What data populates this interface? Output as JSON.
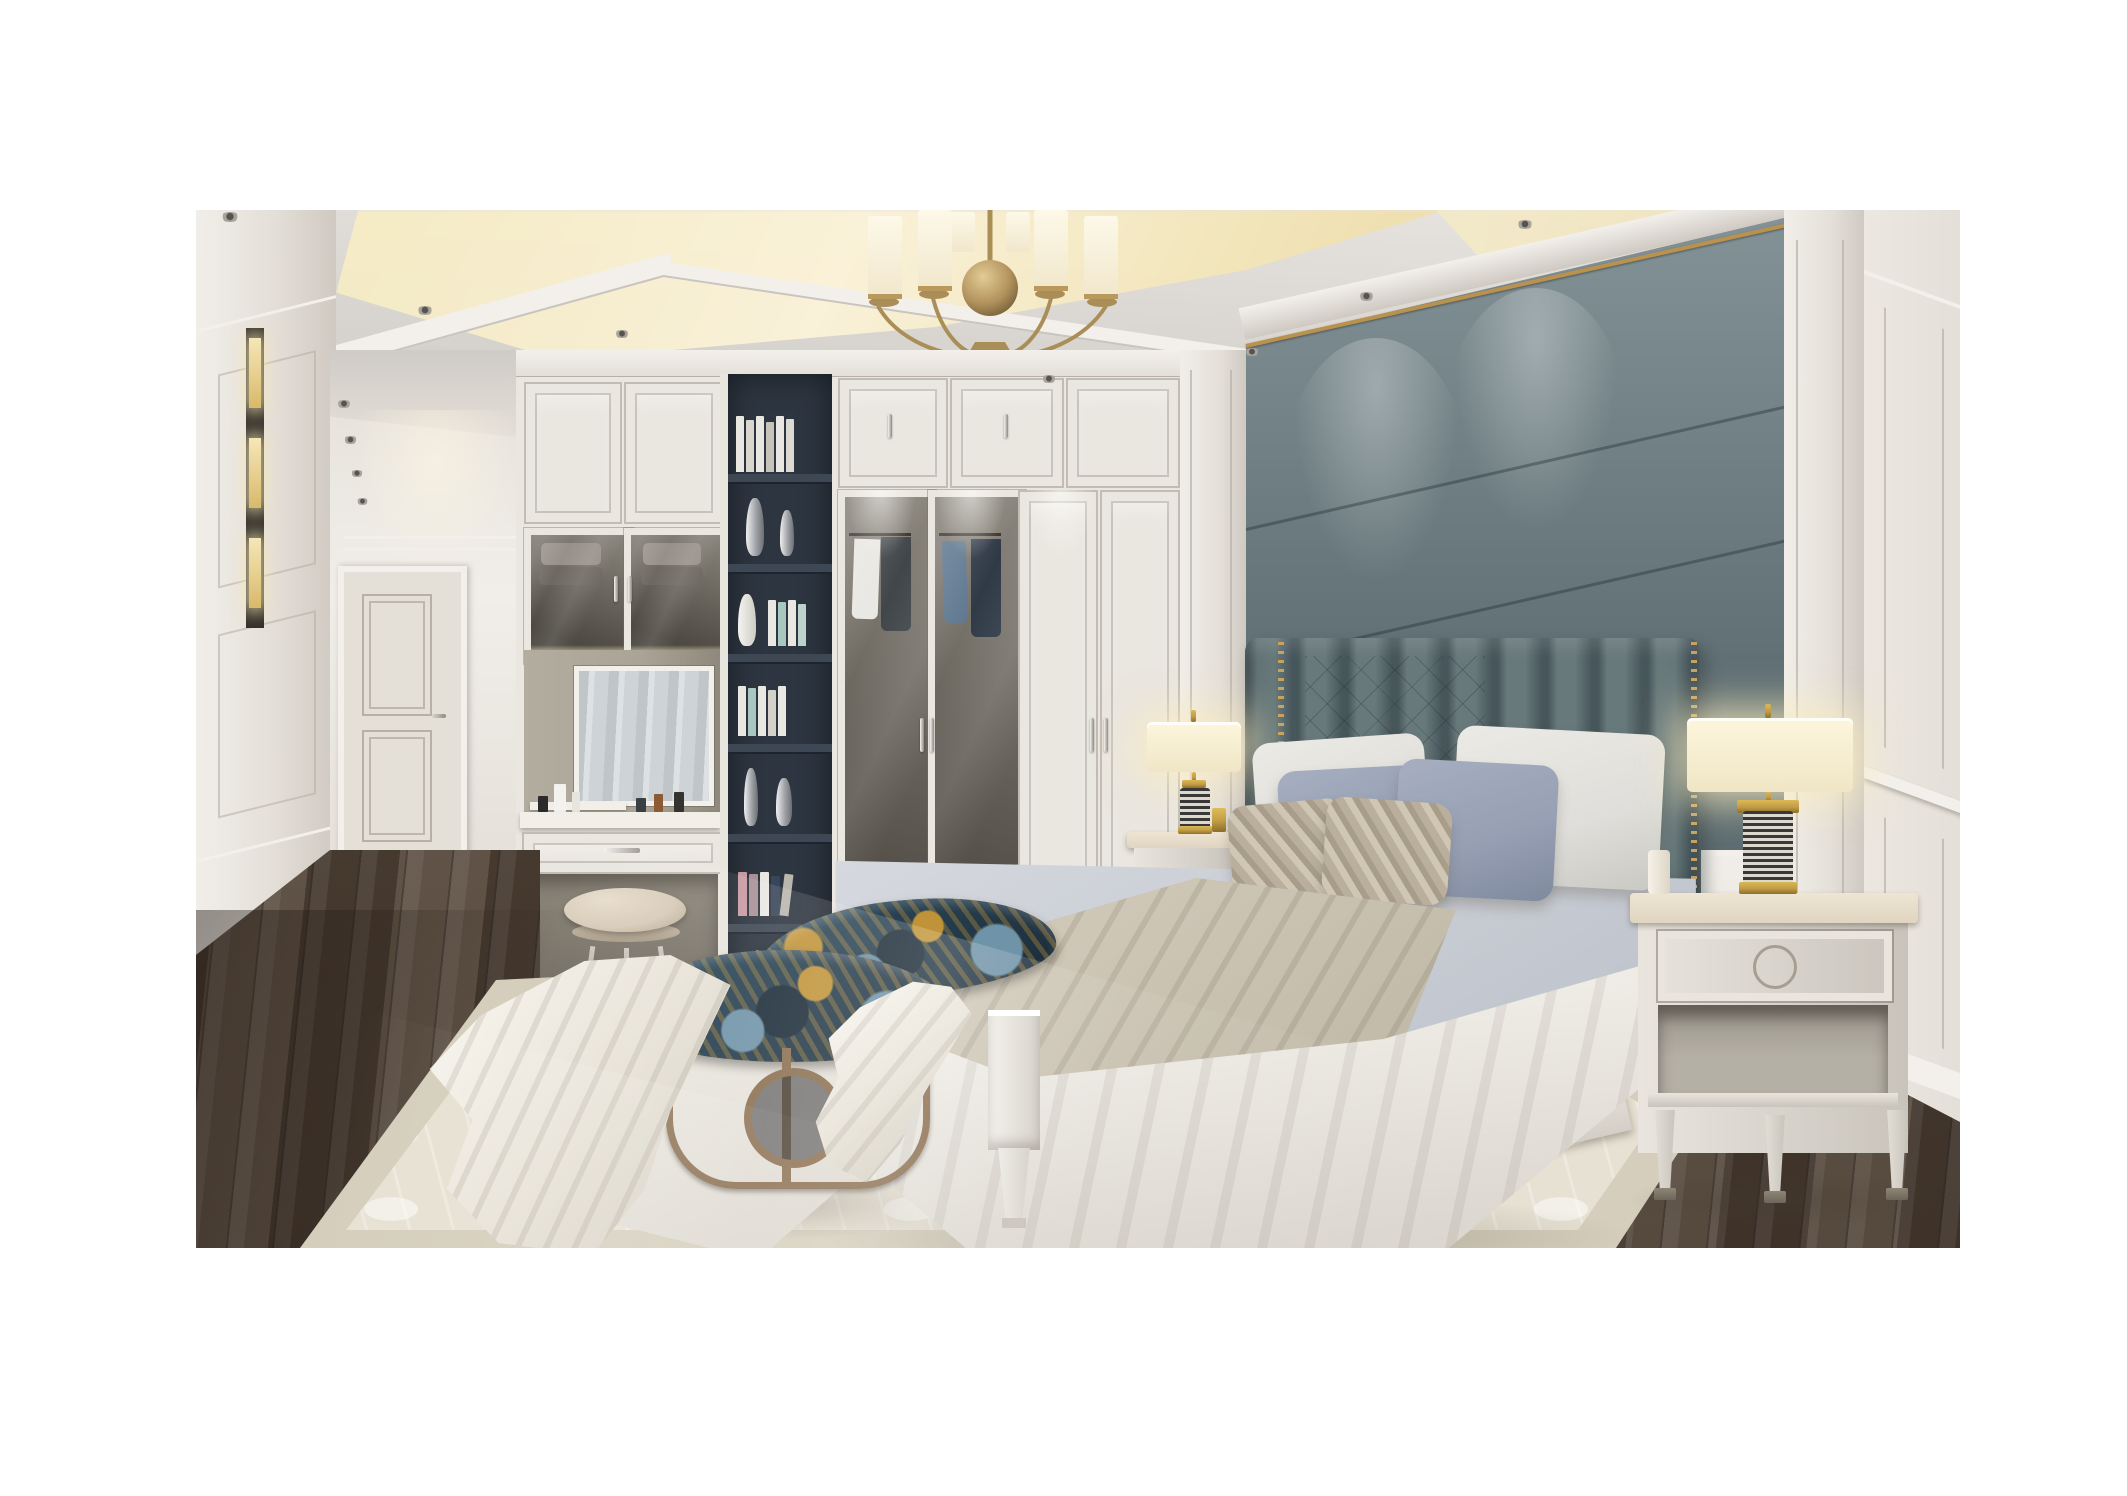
{
  "image": {
    "type": "photorealistic interior render",
    "room": "luxury neoclassical master bedroom with dressing hallway",
    "visible_text": null,
    "objects": [
      "brass chandelier with eight cylindrical frosted glass shades and central sphere",
      "tray ceiling with warm perimeter cove lighting and recessed round downlights",
      "white paneled hallway with interior two-panel door and lit display niches",
      "white built-in wardrobe wall with paneled doors and silver bar pulls",
      "glass display cabinet with folded towels and warm interior light",
      "built-in vanity with mirror, cosmetics, drawer and upholstered stool",
      "dark charcoal bookshelf niche with white books and silver vases",
      "two glass wardrobe doors showing hanging shirts and jackets",
      "gray-teal upholstered accent wall panels with brass top trim",
      "channel-tufted gray headboard with diamond quilting and brass nailhead trim",
      "king bed with light gray duvet, white draped sheet and taupe throw blanket",
      "pillows: two white euro pillows, two dusty-blue pillows, two striped tan accent pillows",
      "white wood bed frame with square tapered-leg footboard posts",
      "pair of cream nightstands with ring-pull drawer, open shelf and metal-capped legs",
      "two table lamps with cream drum shades and gold-banded striped column bases (lit)",
      "upholstered bench and round ottoman in teal-gold peacock fabric with bronze base",
      "white throw blanket draped over ottoman onto rug",
      "cream tone-on-tone patterned area rug with irregular edge",
      "dark walnut diagonal plank wood floor",
      "white wainscot side wall with chair rail and baseboard"
    ],
    "lighting": "warm cove glow and lit lamps against neutral daylight"
  },
  "palette": {
    "margin": "#ffffff",
    "ceil_hi": "#e8e5e1",
    "ceil_lo": "#cfcbc6",
    "cove": "#f6ecc6",
    "cove_core": "#fbf3d8",
    "cove_deep": "#f0e0ae",
    "wall_hi": "#f1eee9",
    "wall_mid": "#e4dfd8",
    "wall_lo": "#cfc9c2",
    "molding": "#f3f0ec",
    "molding_dk": "#c9c4be",
    "wardrobe": "#eae6e0",
    "panel_line": "#b7b0a7",
    "niche": "#f5e7b8",
    "glass_hi": "#8a857c",
    "glass_lo": "#4e4a43",
    "towel_hi": "#97908a",
    "towel_lo": "#6e6862",
    "mirror_hi": "#dde1e3",
    "mirror_lo": "#bfc5c8",
    "vanity_back": "#aaa496",
    "counter": "#f2efe8",
    "stool": "#d8cbb9",
    "silver": "#b6b1a9",
    "shelf_bg": "#2d3540",
    "shelf_board": "#3e4754",
    "book_white": "#e9e7e1",
    "book_teal": "#a9c7c1",
    "book_pink": "#c79aa0",
    "book_navy": "#39455a",
    "vase_hi": "#f0f0f2",
    "vase_lo": "#6c6f73",
    "accent_hi": "#839296",
    "accent_lo": "#5c6c71",
    "accent_gold": "#b8924e",
    "hb_hi": "#68797b",
    "hb_lo": "#46565b",
    "nail_gold": "#c7a160",
    "sheet": "#efece6",
    "sheet_dk": "#d6d1c9",
    "duvet_hi": "#d7dae0",
    "duvet_lo": "#b8bdc6",
    "throw_hi": "#d8d1c1",
    "throw_lo": "#b7af9d",
    "pil_white": "#dfdeda",
    "pil_blue": "#97a0b4",
    "pil_tan": "#b9af9c",
    "bench_teal": "#2f4d60",
    "bench_navy": "#1c2c39",
    "bench_gold": "#c09338",
    "bench_blue": "#6f93a8",
    "bronze": "#8a6e4f",
    "bed_wood_hi": "#f0ede7",
    "bed_wood_lo": "#d3cec6",
    "wood_hi": "#7b6a59",
    "wood_mid": "#645447",
    "wood_dk": "#483b30",
    "rug_field": "#e7e1d3",
    "rug_border": "#d5cebc",
    "rug_pat": "#f1ecdf",
    "shade_hi": "#fdf6dd",
    "shade_lo": "#f0e6c6",
    "gold": "#c19c44",
    "lamp_dark": "#383838",
    "lamp_light": "#ddd8cd",
    "nstand_hi": "#e9e5de",
    "nstand_lo": "#c8c3bb",
    "nstand_top": "#eee5d2",
    "door_leaf": "#e4dfd7",
    "glow": "rgba(250,236,190,0.8)",
    "shadow": "rgba(70,60,50,0.30)"
  }
}
